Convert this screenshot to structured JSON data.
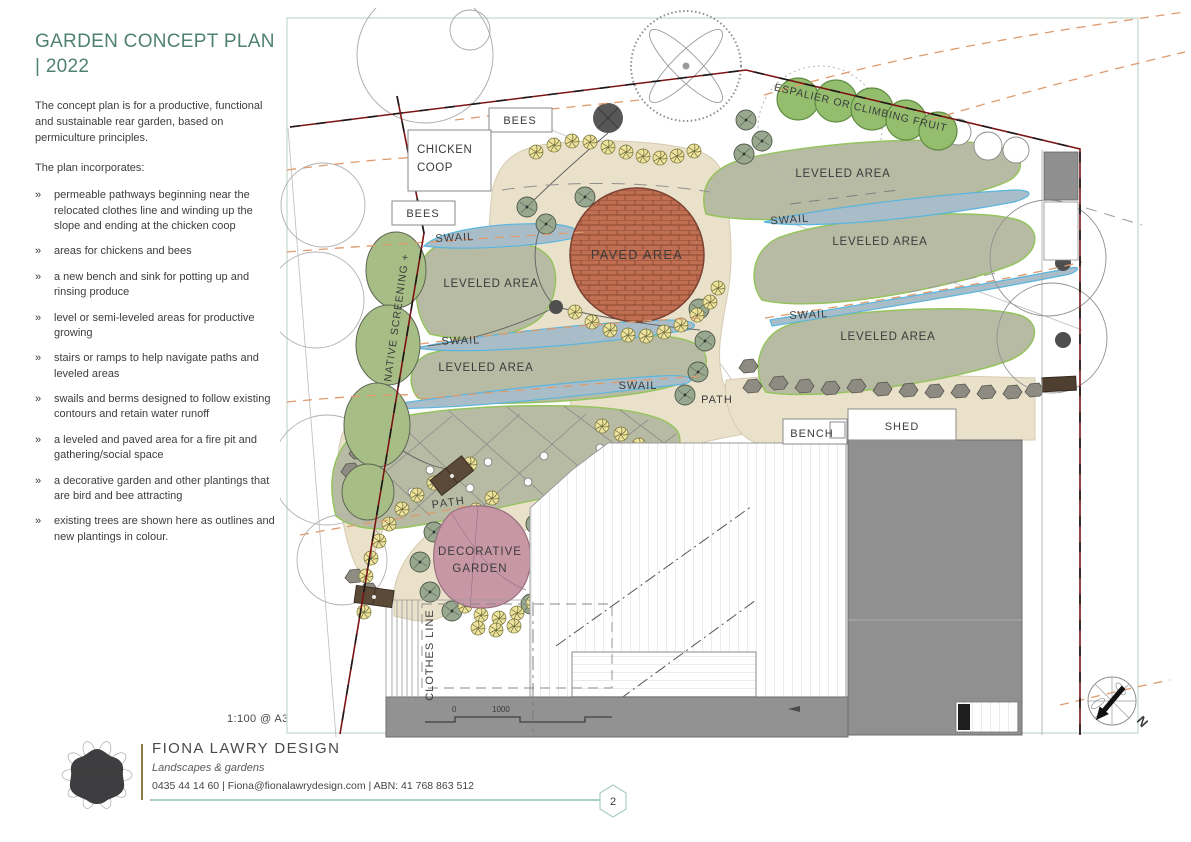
{
  "sidebar": {
    "title": "GARDEN CONCEPT PLAN | 2022",
    "intro": "The concept plan is for a productive, functional and sustainable rear garden, based on permiculture principles.",
    "incorporates_heading": "The plan incorporates:",
    "bullet_marker": "»",
    "bullets": [
      "permeable pathways beginning near the relocated clothes line and winding up the slope and ending at the chicken coop",
      "areas for chickens and bees",
      "a new bench and sink for potting up and rinsing produce",
      "level or semi-leveled areas for productive growing",
      "stairs or ramps to help navigate paths and leveled areas",
      "swails and berms designed to follow existing contours and retain water runoff",
      "a leveled and paved area for a fire pit and gathering/social space",
      "a decorative garden and other plantings that are bird and bee attracting",
      "existing trees are shown here as outlines and new plantings in colour."
    ],
    "scale_note": "1:100 @ A3"
  },
  "plan": {
    "labels": {
      "bees": "BEES",
      "chicken_coop_1": "CHICKEN",
      "chicken_coop_2": "COOP",
      "swail": "SWAIL",
      "leveled_area": "LEVELED AREA",
      "paved_area": "PAVED AREA",
      "path": "PATH",
      "native_screening": "NATIVE SCREENING +",
      "espalier": "ESPALIER OR CLIMBING FRUIT",
      "bench": "BENCH",
      "shed": "SHED",
      "decorative_1": "DECORATIVE",
      "decorative_2": "GARDEN",
      "clothes_line": "CLOTHES LINE",
      "north": "N",
      "scale_zero": "0",
      "scale_thousand": "1000"
    },
    "colors": {
      "accent_teal": "#4f8173",
      "boundary_red": "#7c1313",
      "leveled_green": "#b8bba4",
      "swail_blue": "#a9bdc9",
      "paved_brick": "#c06f52",
      "decorative_pink": "#c897a6",
      "planting_green": "#95bd6e",
      "contour_orange": "#de9b6d"
    }
  },
  "footer": {
    "company": "FIONA LAWRY DESIGN",
    "tagline": "Landscapes & gardens",
    "contact": "0435 44 14 60 | Fiona@fionalawrydesign.com | ABN: 41 768 863 512",
    "page_number": "2",
    "logo_line1": "FIONA LAWRY",
    "logo_line2": "DESIGN"
  }
}
